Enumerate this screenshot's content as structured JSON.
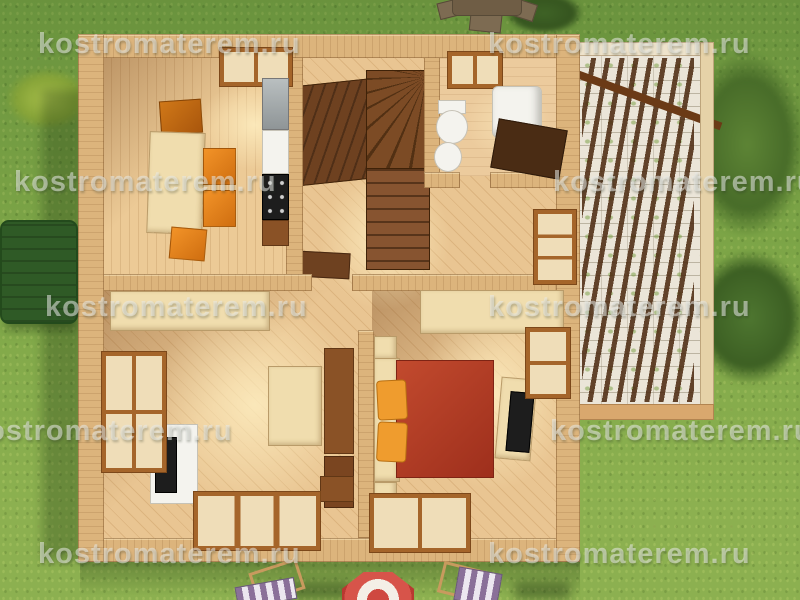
{
  "watermark": {
    "text": "kostromaterem.ru",
    "positions": [
      {
        "x": 38,
        "y": 28
      },
      {
        "x": 488,
        "y": 28
      },
      {
        "x": 14,
        "y": 166
      },
      {
        "x": 553,
        "y": 166
      },
      {
        "x": 45,
        "y": 291
      },
      {
        "x": 488,
        "y": 291
      },
      {
        "x": -30,
        "y": 415
      },
      {
        "x": 550,
        "y": 415
      },
      {
        "x": 38,
        "y": 538
      },
      {
        "x": 488,
        "y": 538
      }
    ]
  },
  "colors": {
    "grass_green": "#7fa84a",
    "house_wall_tan": "#dcb47c",
    "floor_wood": "#e8c28c",
    "stair_dark_wood": "#6e4120",
    "furniture_cream": "#f0ddae",
    "chair_orange": "#e8821a",
    "bed_red": "#b23a24",
    "pillow_orange": "#ef9c2e",
    "terrace_stone_white": "#ebe5d8",
    "pergola_dark_brown": "#5e3a1b",
    "garden_box_green": "#2f5a26",
    "parasol_red": "#cf4840",
    "deckchair_stripe_purple": "#8a7099",
    "watermark_gray": "#e9ebe7"
  }
}
